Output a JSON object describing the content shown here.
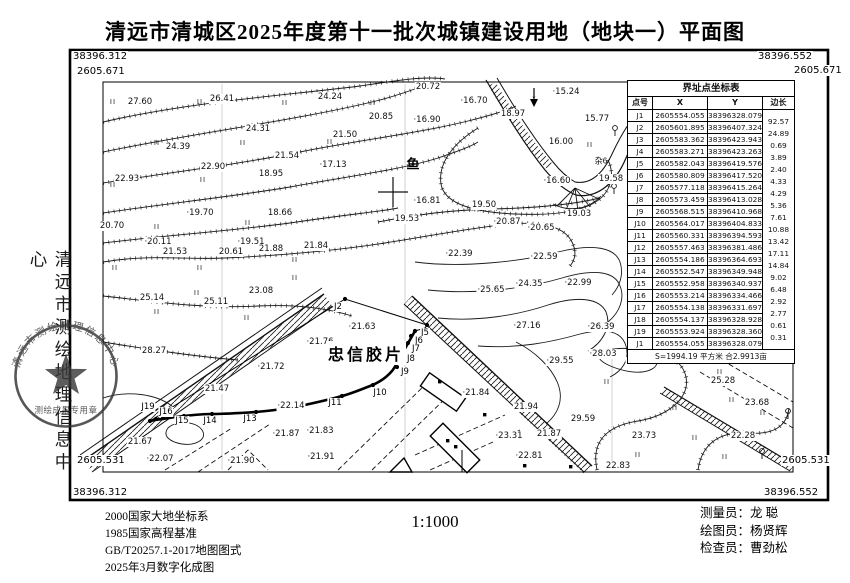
{
  "title": "清远市清城区2025年度第十一批次城镇建设用地（地块一）平面图",
  "frame": {
    "tl_y": "38396.312",
    "tl_x": "2605.671",
    "tr_y": "38396.552",
    "tr_x": "2605.671",
    "bl_x": "2605.531",
    "bl_y": "38396.312",
    "br_x": "2605.531",
    "br_y": "38396.552"
  },
  "table": {
    "title": "界址点坐标表",
    "headers": [
      "点号",
      "X",
      "Y",
      "边长"
    ],
    "rows": [
      {
        "pt": "J1",
        "x": "2605554.055",
        "y": "38396328.079",
        "len": "92.57"
      },
      {
        "pt": "J2",
        "x": "2605601.895",
        "y": "38396407.324",
        "len": "24.89"
      },
      {
        "pt": "J3",
        "x": "2605583.362",
        "y": "38396423.943",
        "len": "0.69"
      },
      {
        "pt": "J4",
        "x": "2605583.271",
        "y": "38396423.263",
        "len": "3.89"
      },
      {
        "pt": "J5",
        "x": "2605582.043",
        "y": "38396419.576",
        "len": "2.40"
      },
      {
        "pt": "J6",
        "x": "2605580.809",
        "y": "38396417.520",
        "len": "4.33"
      },
      {
        "pt": "J7",
        "x": "2605577.118",
        "y": "38396415.264",
        "len": "4.29"
      },
      {
        "pt": "J8",
        "x": "2605573.459",
        "y": "38396413.028",
        "len": "5.36"
      },
      {
        "pt": "J9",
        "x": "2605568.515",
        "y": "38396410.968",
        "len": "7.61"
      },
      {
        "pt": "J10",
        "x": "2605564.017",
        "y": "38396404.833",
        "len": "10.88"
      },
      {
        "pt": "J11",
        "x": "2605560.331",
        "y": "38396394.593",
        "len": "13.42"
      },
      {
        "pt": "J12",
        "x": "2605557.463",
        "y": "38396381.486",
        "len": "17.11"
      },
      {
        "pt": "J13",
        "x": "2605554.186",
        "y": "38396364.693",
        "len": "14.84"
      },
      {
        "pt": "J14",
        "x": "2605552.547",
        "y": "38396349.948",
        "len": "9.02"
      },
      {
        "pt": "J15",
        "x": "2605552.958",
        "y": "38396340.937",
        "len": "6.48"
      },
      {
        "pt": "J16",
        "x": "2605553.214",
        "y": "38396334.466",
        "len": "2.92"
      },
      {
        "pt": "J17",
        "x": "2605554.138",
        "y": "38396331.697",
        "len": "2.77"
      },
      {
        "pt": "J18",
        "x": "2605554.137",
        "y": "38396328.928",
        "len": "0.61"
      },
      {
        "pt": "J19",
        "x": "2605553.924",
        "y": "38396328.360",
        "len": "0.31"
      },
      {
        "pt": "J1",
        "x": "2605554.055",
        "y": "38396328.079",
        "len": ""
      }
    ],
    "area_note": "S=1994.19 平方米 合2.9913亩"
  },
  "map": {
    "parcel_name": "忠信胶片",
    "pond_label": "鱼",
    "veg_note": "杂6",
    "flow_arrow": "↓",
    "grass_glyph": "II",
    "elevations": [
      {
        "t": "27.60",
        "x": 140,
        "y": 102
      },
      {
        "t": "26.41",
        "x": 222,
        "y": 99
      },
      {
        "t": "24.24",
        "x": 330,
        "y": 97
      },
      {
        "t": "24.31",
        "x": 258,
        "y": 129
      },
      {
        "t": "24.39",
        "x": 178,
        "y": 147
      },
      {
        "t": "21.50",
        "x": 345,
        "y": 135
      },
      {
        "t": "21.54",
        "x": 287,
        "y": 156
      },
      {
        "t": "22.90",
        "x": 213,
        "y": 167
      },
      {
        "t": "22.93",
        "x": 127,
        "y": 179
      },
      {
        "t": "·17.13",
        "x": 333,
        "y": 165
      },
      {
        "t": "18.95",
        "x": 271,
        "y": 174
      },
      {
        "t": "·19.70",
        "x": 200,
        "y": 213
      },
      {
        "t": "18.66",
        "x": 280,
        "y": 213
      },
      {
        "t": "20.70",
        "x": 112,
        "y": 226
      },
      {
        "t": "·20.11",
        "x": 158,
        "y": 242
      },
      {
        "t": "·19.51",
        "x": 251,
        "y": 242
      },
      {
        "t": "21.53",
        "x": 175,
        "y": 252
      },
      {
        "t": "20.61",
        "x": 231,
        "y": 252
      },
      {
        "t": "21.88",
        "x": 271,
        "y": 249
      },
      {
        "t": "21.84",
        "x": 316,
        "y": 246
      },
      {
        "t": "25.14",
        "x": 152,
        "y": 298
      },
      {
        "t": "25.11",
        "x": 216,
        "y": 302
      },
      {
        "t": "23.08",
        "x": 261,
        "y": 291
      },
      {
        "t": "20.72",
        "x": 428,
        "y": 87
      },
      {
        "t": "·16.70",
        "x": 474,
        "y": 101
      },
      {
        "t": "·15.24",
        "x": 566,
        "y": 92
      },
      {
        "t": "20.85",
        "x": 381,
        "y": 117
      },
      {
        "t": "·16.90",
        "x": 427,
        "y": 120
      },
      {
        "t": "18.97",
        "x": 513,
        "y": 114
      },
      {
        "t": "15.77",
        "x": 597,
        "y": 119
      },
      {
        "t": "16.00",
        "x": 561,
        "y": 142
      },
      {
        "t": "·16.60",
        "x": 557,
        "y": 181
      },
      {
        "t": "19.58",
        "x": 611,
        "y": 179
      },
      {
        "t": "·16.81",
        "x": 427,
        "y": 201
      },
      {
        "t": "19.50",
        "x": 484,
        "y": 205
      },
      {
        "t": "19.53",
        "x": 407,
        "y": 219
      },
      {
        "t": "·20.87",
        "x": 507,
        "y": 222
      },
      {
        "t": "·20.65",
        "x": 541,
        "y": 228
      },
      {
        "t": "19.03",
        "x": 579,
        "y": 214
      },
      {
        "t": "·22.39",
        "x": 459,
        "y": 254
      },
      {
        "t": "·22.59",
        "x": 544,
        "y": 257
      },
      {
        "t": "·24.35",
        "x": 529,
        "y": 284
      },
      {
        "t": "·22.99",
        "x": 578,
        "y": 283
      },
      {
        "t": "·25.65",
        "x": 491,
        "y": 290
      },
      {
        "t": "·27.16",
        "x": 527,
        "y": 326
      },
      {
        "t": "·26.39",
        "x": 601,
        "y": 327
      },
      {
        "t": "·29.55",
        "x": 560,
        "y": 361
      },
      {
        "t": "·28.03",
        "x": 603,
        "y": 354
      },
      {
        "t": "·30.03",
        "x": 640,
        "y": 362
      },
      {
        "t": "29.59",
        "x": 583,
        "y": 419
      },
      {
        "t": "·24.91",
        "x": 746,
        "y": 347
      },
      {
        "t": "25.28",
        "x": 723,
        "y": 381
      },
      {
        "t": "23.68",
        "x": 757,
        "y": 403
      },
      {
        "t": "22.28",
        "x": 743,
        "y": 436
      },
      {
        "t": "23.73",
        "x": 644,
        "y": 436
      },
      {
        "t": "22.83",
        "x": 618,
        "y": 466
      },
      {
        "t": "·23.31",
        "x": 509,
        "y": 436
      },
      {
        "t": "·22.81",
        "x": 529,
        "y": 456
      },
      {
        "t": "21.94",
        "x": 526,
        "y": 407
      },
      {
        "t": "21.87",
        "x": 549,
        "y": 434
      },
      {
        "t": "·21.63",
        "x": 362,
        "y": 327
      },
      {
        "t": "·21.76",
        "x": 320,
        "y": 342
      },
      {
        "t": "·21.72",
        "x": 271,
        "y": 367
      },
      {
        "t": "·22.14",
        "x": 291,
        "y": 406
      },
      {
        "t": "·21.84",
        "x": 476,
        "y": 393
      },
      {
        "t": "21.47",
        "x": 217,
        "y": 389
      },
      {
        "t": "28.27",
        "x": 154,
        "y": 351
      },
      {
        "t": "21.67",
        "x": 140,
        "y": 442
      },
      {
        "t": "·22.07",
        "x": 160,
        "y": 459
      },
      {
        "t": "·21.90",
        "x": 241,
        "y": 461
      },
      {
        "t": "·21.91",
        "x": 321,
        "y": 457
      },
      {
        "t": "·21.87",
        "x": 286,
        "y": 434
      },
      {
        "t": "·21.83",
        "x": 320,
        "y": 431
      }
    ],
    "boundary_labels": [
      {
        "t": "J2",
        "x": 338,
        "y": 307
      },
      {
        "t": "J5",
        "x": 425,
        "y": 333
      },
      {
        "t": "J6",
        "x": 419,
        "y": 341
      },
      {
        "t": "J7",
        "x": 416,
        "y": 349
      },
      {
        "t": "J8",
        "x": 411,
        "y": 359
      },
      {
        "t": "J9",
        "x": 405,
        "y": 372
      },
      {
        "t": "J10",
        "x": 380,
        "y": 393
      },
      {
        "t": "J11",
        "x": 335,
        "y": 403
      },
      {
        "t": "J13",
        "x": 250,
        "y": 419
      },
      {
        "t": "J14",
        "x": 210,
        "y": 421
      },
      {
        "t": "J15",
        "x": 182,
        "y": 421
      },
      {
        "t": "J16",
        "x": 166,
        "y": 412
      },
      {
        "t": "J19",
        "x": 148,
        "y": 407
      }
    ],
    "grass_marks": [
      [
        113,
        102
      ],
      [
        200,
        102
      ],
      [
        285,
        103
      ],
      [
        373,
        103
      ],
      [
        157,
        143
      ],
      [
        243,
        143
      ],
      [
        330,
        142
      ],
      [
        113,
        185
      ],
      [
        203,
        180
      ],
      [
        157,
        227
      ],
      [
        248,
        223
      ],
      [
        115,
        268
      ],
      [
        200,
        268
      ],
      [
        295,
        260
      ],
      [
        295,
        278
      ],
      [
        197,
        293
      ],
      [
        157,
        312
      ],
      [
        247,
        318
      ],
      [
        590,
        145
      ],
      [
        690,
        352
      ],
      [
        607,
        382
      ],
      [
        675,
        408
      ],
      [
        732,
        400
      ],
      [
        763,
        413
      ],
      [
        695,
        438
      ],
      [
        638,
        455
      ],
      [
        725,
        457
      ],
      [
        720,
        372
      ]
    ]
  },
  "footer": {
    "datum": [
      "2000国家大地坐标系",
      "1985国家高程基准",
      "GB/T20257.1-2017地图图式",
      "2025年3月数字化成图"
    ],
    "scale": "1:1000",
    "credits": [
      {
        "role": "测量员：",
        "name": "龙  聪"
      },
      {
        "role": "绘图员：",
        "name": "杨贤辉"
      },
      {
        "role": "检查员：",
        "name": "曹劲松"
      }
    ]
  },
  "side": {
    "org": "清远市测绘地理信息中心",
    "stamp_top": "清远市测绘地理信息中心",
    "stamp_bottom": "测绘成果专用章"
  }
}
